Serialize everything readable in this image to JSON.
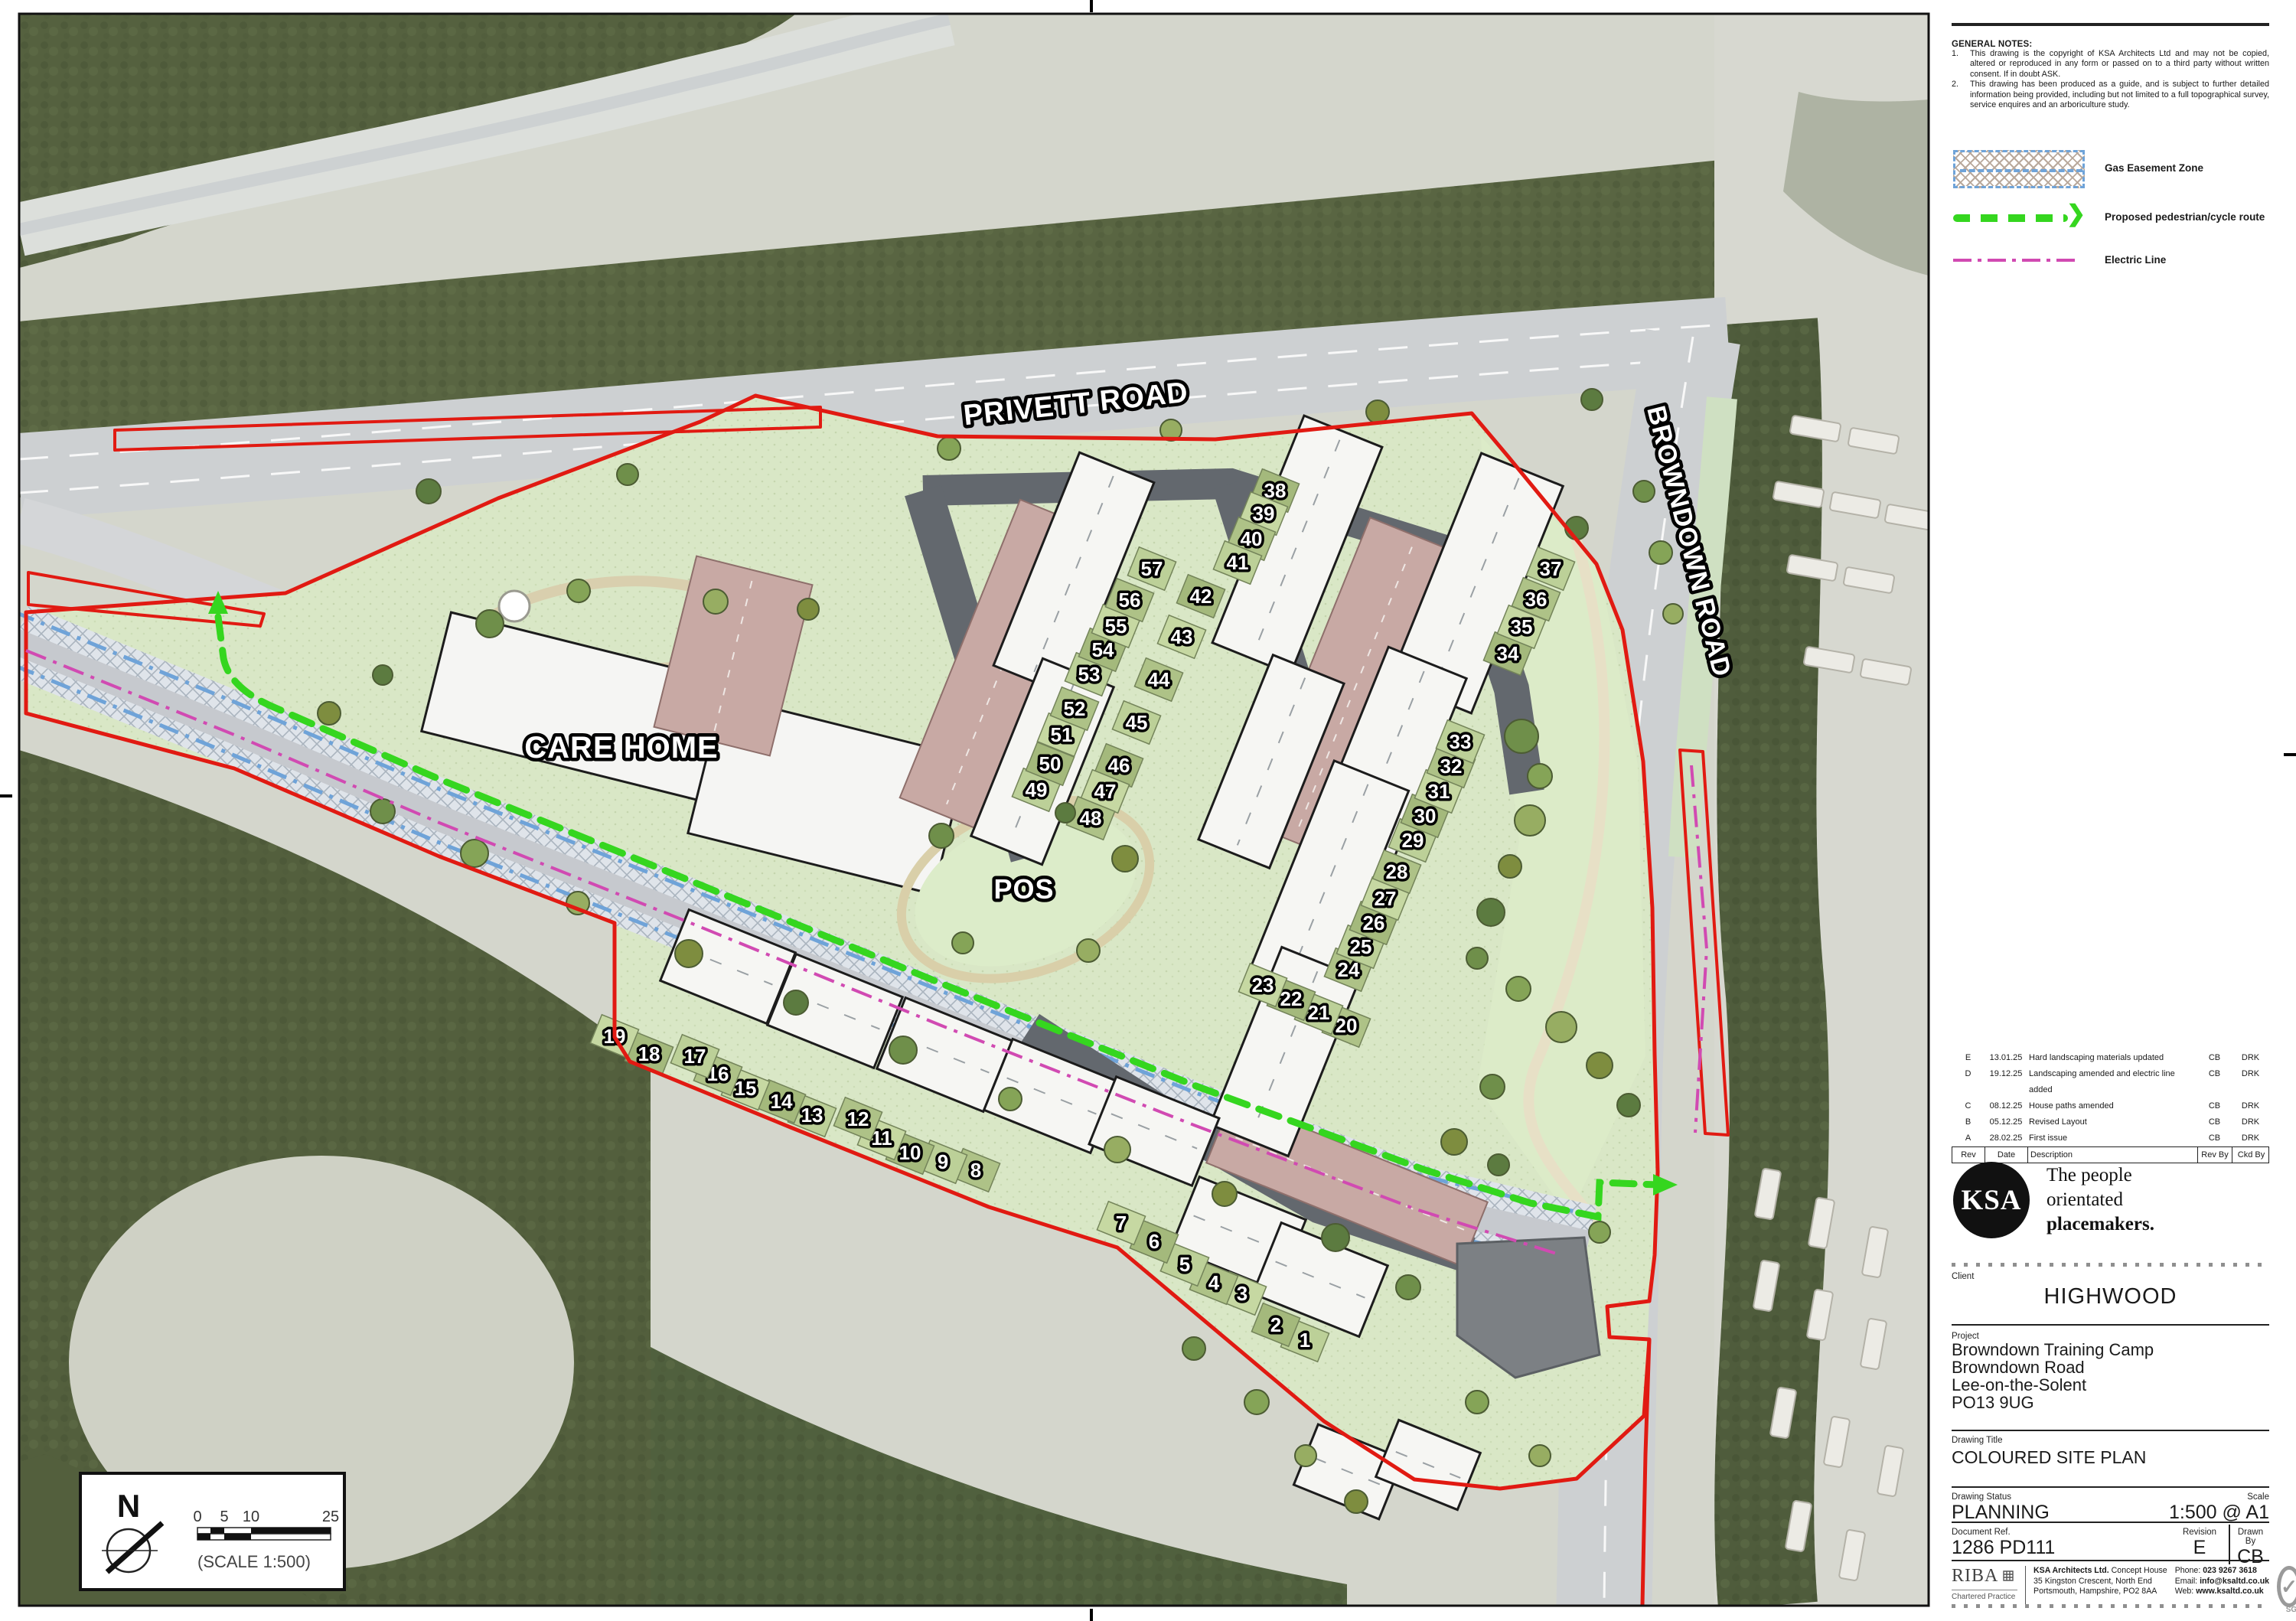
{
  "notes": {
    "title": "GENERAL NOTES:",
    "items": [
      {
        "num": "1.",
        "text": "This drawing is the copyright of KSA Architects Ltd and may not be copied, altered or reproduced in any form or passed on to a third party without written consent. If in doubt ASK."
      },
      {
        "num": "2.",
        "text": "This drawing has been produced as a guide, and is subject to further detailed information being provided, including but not limited to a full topographical survey, service enquires and an arboriculture study."
      }
    ]
  },
  "legend": {
    "items": [
      {
        "key": "gas-easement",
        "label": "Gas Easement Zone",
        "color": "#6fa3d8"
      },
      {
        "key": "pedestrian-cycle-route",
        "label": "Proposed pedestrian/cycle route",
        "color": "#35d61f"
      },
      {
        "key": "electric-line",
        "label": "Electric Line",
        "color": "#d14ab2"
      }
    ]
  },
  "revisions": {
    "headers": [
      "Rev",
      "Date",
      "Description",
      "Rev By",
      "Ckd By"
    ],
    "rows": [
      [
        "E",
        "13.01.25",
        "Hard landscaping materials updated",
        "CB",
        "DRK"
      ],
      [
        "D",
        "19.12.25",
        "Landscaping amended and electric line added",
        "CB",
        "DRK"
      ],
      [
        "C",
        "08.12.25",
        "House paths amended",
        "CB",
        "DRK"
      ],
      [
        "B",
        "05.12.25",
        "Revised Layout",
        "CB",
        "DRK"
      ],
      [
        "A",
        "28.02.25",
        "First issue",
        "CB",
        "DRK"
      ]
    ]
  },
  "branding": {
    "logo": "KSA",
    "tagline_lines": [
      "The people",
      "orientated",
      "placemakers."
    ],
    "riba_name": "RIBA",
    "riba_sub": "Chartered Practice",
    "sgs": "SGS"
  },
  "title_block": {
    "client_label": "Client",
    "client": "HIGHWOOD",
    "project_label": "Project",
    "project_lines": [
      "Browndown Training Camp",
      "Browndown Road",
      "Lee-on-the-Solent",
      "PO13 9UG"
    ],
    "drawing_title_label": "Drawing Title",
    "drawing_title": "COLOURED SITE PLAN",
    "status_label": "Drawing Status",
    "status": "PLANNING",
    "scale_label": "Scale",
    "scale": "1:500 @ A1",
    "doc_ref_label": "Document Ref.",
    "doc_ref": "1286 PD111",
    "revision_label": "Revision",
    "revision": "E",
    "drawn_by_label": "Drawn By",
    "drawn_by": "CB"
  },
  "firm": {
    "name": "KSA Architects Ltd.",
    "address1": "Concept House",
    "address2": "35 Kingston Crescent, North End",
    "address3": "Portsmouth, Hampshire, PO2 8AA",
    "phone_label": "Phone:",
    "phone": "023 9267 3618",
    "email_label": "Email:",
    "email": "info@ksaltd.co.uk",
    "web_label": "Web:",
    "web": "www.ksaltd.co.uk"
  },
  "plan": {
    "labels": {
      "road1": "PRIVETT ROAD",
      "road2": "BROWNDOWN ROAD",
      "care_home": "CARE HOME",
      "pos": "POS",
      "north": "N",
      "scale_caption": "(SCALE 1:500)"
    },
    "scale_ticks": [
      "0",
      "5",
      "10",
      "25"
    ],
    "colors": {
      "boundary_red": "#e11a12",
      "route_green": "#35d61f",
      "electric_magenta": "#d14ab2",
      "gas_blue": "#6fa3d8",
      "woodland": "#55613f",
      "lawn": "#d9e7c6",
      "parking_pink": "#c8a9a4",
      "road_dark": "#63686e"
    },
    "plots": [
      [
        1,
        1705,
        1751
      ],
      [
        2,
        1667,
        1731
      ],
      [
        3,
        1623,
        1690
      ],
      [
        4,
        1586,
        1676
      ],
      [
        5,
        1548,
        1652
      ],
      [
        6,
        1508,
        1622
      ],
      [
        7,
        1465,
        1598
      ],
      [
        8,
        1275,
        1529
      ],
      [
        9,
        1232,
        1518
      ],
      [
        10,
        1189,
        1506
      ],
      [
        11,
        1152,
        1487
      ],
      [
        12,
        1121,
        1462
      ],
      [
        13,
        1061,
        1457
      ],
      [
        14,
        1021,
        1439
      ],
      [
        15,
        974,
        1422
      ],
      [
        16,
        938,
        1403
      ],
      [
        17,
        908,
        1380
      ],
      [
        18,
        848,
        1377
      ],
      [
        19,
        803,
        1354
      ],
      [
        20,
        1759,
        1340
      ],
      [
        21,
        1723,
        1323
      ],
      [
        22,
        1687,
        1305
      ],
      [
        23,
        1650,
        1287
      ],
      [
        24,
        1762,
        1267
      ],
      [
        25,
        1778,
        1237
      ],
      [
        26,
        1795,
        1206
      ],
      [
        27,
        1810,
        1174
      ],
      [
        28,
        1825,
        1139
      ],
      [
        29,
        1846,
        1098
      ],
      [
        30,
        1862,
        1066
      ],
      [
        31,
        1880,
        1034
      ],
      [
        32,
        1896,
        1001
      ],
      [
        33,
        1908,
        969
      ],
      [
        34,
        1970,
        854
      ],
      [
        35,
        1988,
        819
      ],
      [
        36,
        2007,
        783
      ],
      [
        37,
        2026,
        743
      ],
      [
        38,
        1666,
        641
      ],
      [
        39,
        1651,
        671
      ],
      [
        40,
        1635,
        704
      ],
      [
        41,
        1617,
        735
      ],
      [
        42,
        1569,
        779
      ],
      [
        43,
        1544,
        832
      ],
      [
        44,
        1514,
        888
      ],
      [
        45,
        1485,
        944
      ],
      [
        46,
        1462,
        1000
      ],
      [
        47,
        1444,
        1034
      ],
      [
        48,
        1425,
        1069
      ],
      [
        49,
        1354,
        1032
      ],
      [
        50,
        1372,
        998
      ],
      [
        51,
        1387,
        960
      ],
      [
        52,
        1404,
        926
      ],
      [
        53,
        1423,
        881
      ],
      [
        54,
        1441,
        849
      ],
      [
        55,
        1458,
        818
      ],
      [
        56,
        1476,
        784
      ],
      [
        57,
        1505,
        743
      ]
    ],
    "terraces": [
      [
        1403,
        750,
        105,
        300,
        22
      ],
      [
        1362,
        995,
        100,
        250,
        22
      ],
      [
        1695,
        712,
        110,
        320,
        22
      ],
      [
        1661,
        995,
        100,
        260,
        22
      ],
      [
        1929,
        762,
        115,
        320,
        22
      ],
      [
        1809,
        1005,
        110,
        300,
        22
      ],
      [
        1732,
        1162,
        105,
        320,
        22
      ],
      [
        1679,
        1374,
        110,
        250,
        22
      ],
      [
        951,
        1263,
        150,
        100,
        22
      ],
      [
        1091,
        1321,
        150,
        100,
        22
      ],
      [
        1234,
        1378,
        150,
        100,
        22
      ],
      [
        1374,
        1432,
        150,
        100,
        22
      ],
      [
        1508,
        1478,
        145,
        95,
        22
      ],
      [
        1618,
        1612,
        150,
        100,
        22
      ],
      [
        1725,
        1672,
        150,
        100,
        22
      ],
      [
        1762,
        1923,
        120,
        85,
        22
      ],
      [
        1866,
        1914,
        115,
        80,
        22
      ]
    ],
    "trees": [
      [
        500,
        1060,
        16
      ],
      [
        620,
        1115,
        18
      ],
      [
        755,
        1180,
        15
      ],
      [
        900,
        1246,
        18
      ],
      [
        1040,
        1310,
        16
      ],
      [
        1180,
        1372,
        18
      ],
      [
        1320,
        1436,
        15
      ],
      [
        1460,
        1502,
        17
      ],
      [
        1600,
        1560,
        16
      ],
      [
        1745,
        1617,
        18
      ],
      [
        1988,
        962,
        22
      ],
      [
        2012,
        1014,
        16
      ],
      [
        1999,
        1072,
        20
      ],
      [
        1973,
        1132,
        15
      ],
      [
        1948,
        1192,
        18
      ],
      [
        1930,
        1252,
        14
      ],
      [
        1984,
        1292,
        16
      ],
      [
        2040,
        1342,
        20
      ],
      [
        2090,
        1392,
        17
      ],
      [
        2128,
        1444,
        15
      ],
      [
        1230,
        1092,
        16
      ],
      [
        1258,
        1232,
        14
      ],
      [
        1422,
        1242,
        15
      ],
      [
        1470,
        1122,
        17
      ],
      [
        1392,
        1062,
        13
      ],
      [
        640,
        815,
        18
      ],
      [
        756,
        772,
        15
      ],
      [
        935,
        786,
        16
      ],
      [
        1056,
        796,
        14
      ],
      [
        560,
        642,
        16
      ],
      [
        820,
        620,
        14
      ],
      [
        1240,
        586,
        15
      ],
      [
        1530,
        562,
        14
      ],
      [
        1800,
        538,
        15
      ],
      [
        2080,
        522,
        14
      ],
      [
        2148,
        642,
        14
      ],
      [
        2170,
        722,
        15
      ],
      [
        2186,
        802,
        13
      ],
      [
        1900,
        1492,
        17
      ],
      [
        1958,
        1522,
        14
      ],
      [
        1840,
        1682,
        16
      ],
      [
        1930,
        1832,
        15
      ],
      [
        2012,
        1902,
        14
      ],
      [
        430,
        932,
        15
      ],
      [
        500,
        882,
        13
      ],
      [
        1560,
        1762,
        15
      ],
      [
        1642,
        1832,
        16
      ],
      [
        1706,
        1902,
        14
      ],
      [
        1772,
        1962,
        15
      ],
      [
        2060,
        690,
        15
      ],
      [
        1950,
        1420,
        16
      ],
      [
        2090,
        1610,
        14
      ]
    ],
    "caravans": [
      [
        2372,
        560,
        10
      ],
      [
        2448,
        576,
        10
      ],
      [
        2350,
        646,
        10
      ],
      [
        2424,
        660,
        10
      ],
      [
        2496,
        676,
        10
      ],
      [
        2368,
        742,
        10
      ],
      [
        2442,
        758,
        10
      ],
      [
        2390,
        862,
        10
      ],
      [
        2464,
        878,
        10
      ],
      [
        2310,
        1560,
        100
      ],
      [
        2380,
        1598,
        100
      ],
      [
        2450,
        1636,
        100
      ],
      [
        2308,
        1680,
        100
      ],
      [
        2378,
        1718,
        100
      ],
      [
        2448,
        1756,
        100
      ],
      [
        2330,
        1846,
        100
      ],
      [
        2400,
        1884,
        100
      ],
      [
        2470,
        1922,
        100
      ],
      [
        2350,
        1994,
        100
      ],
      [
        2420,
        2032,
        100
      ]
    ]
  }
}
